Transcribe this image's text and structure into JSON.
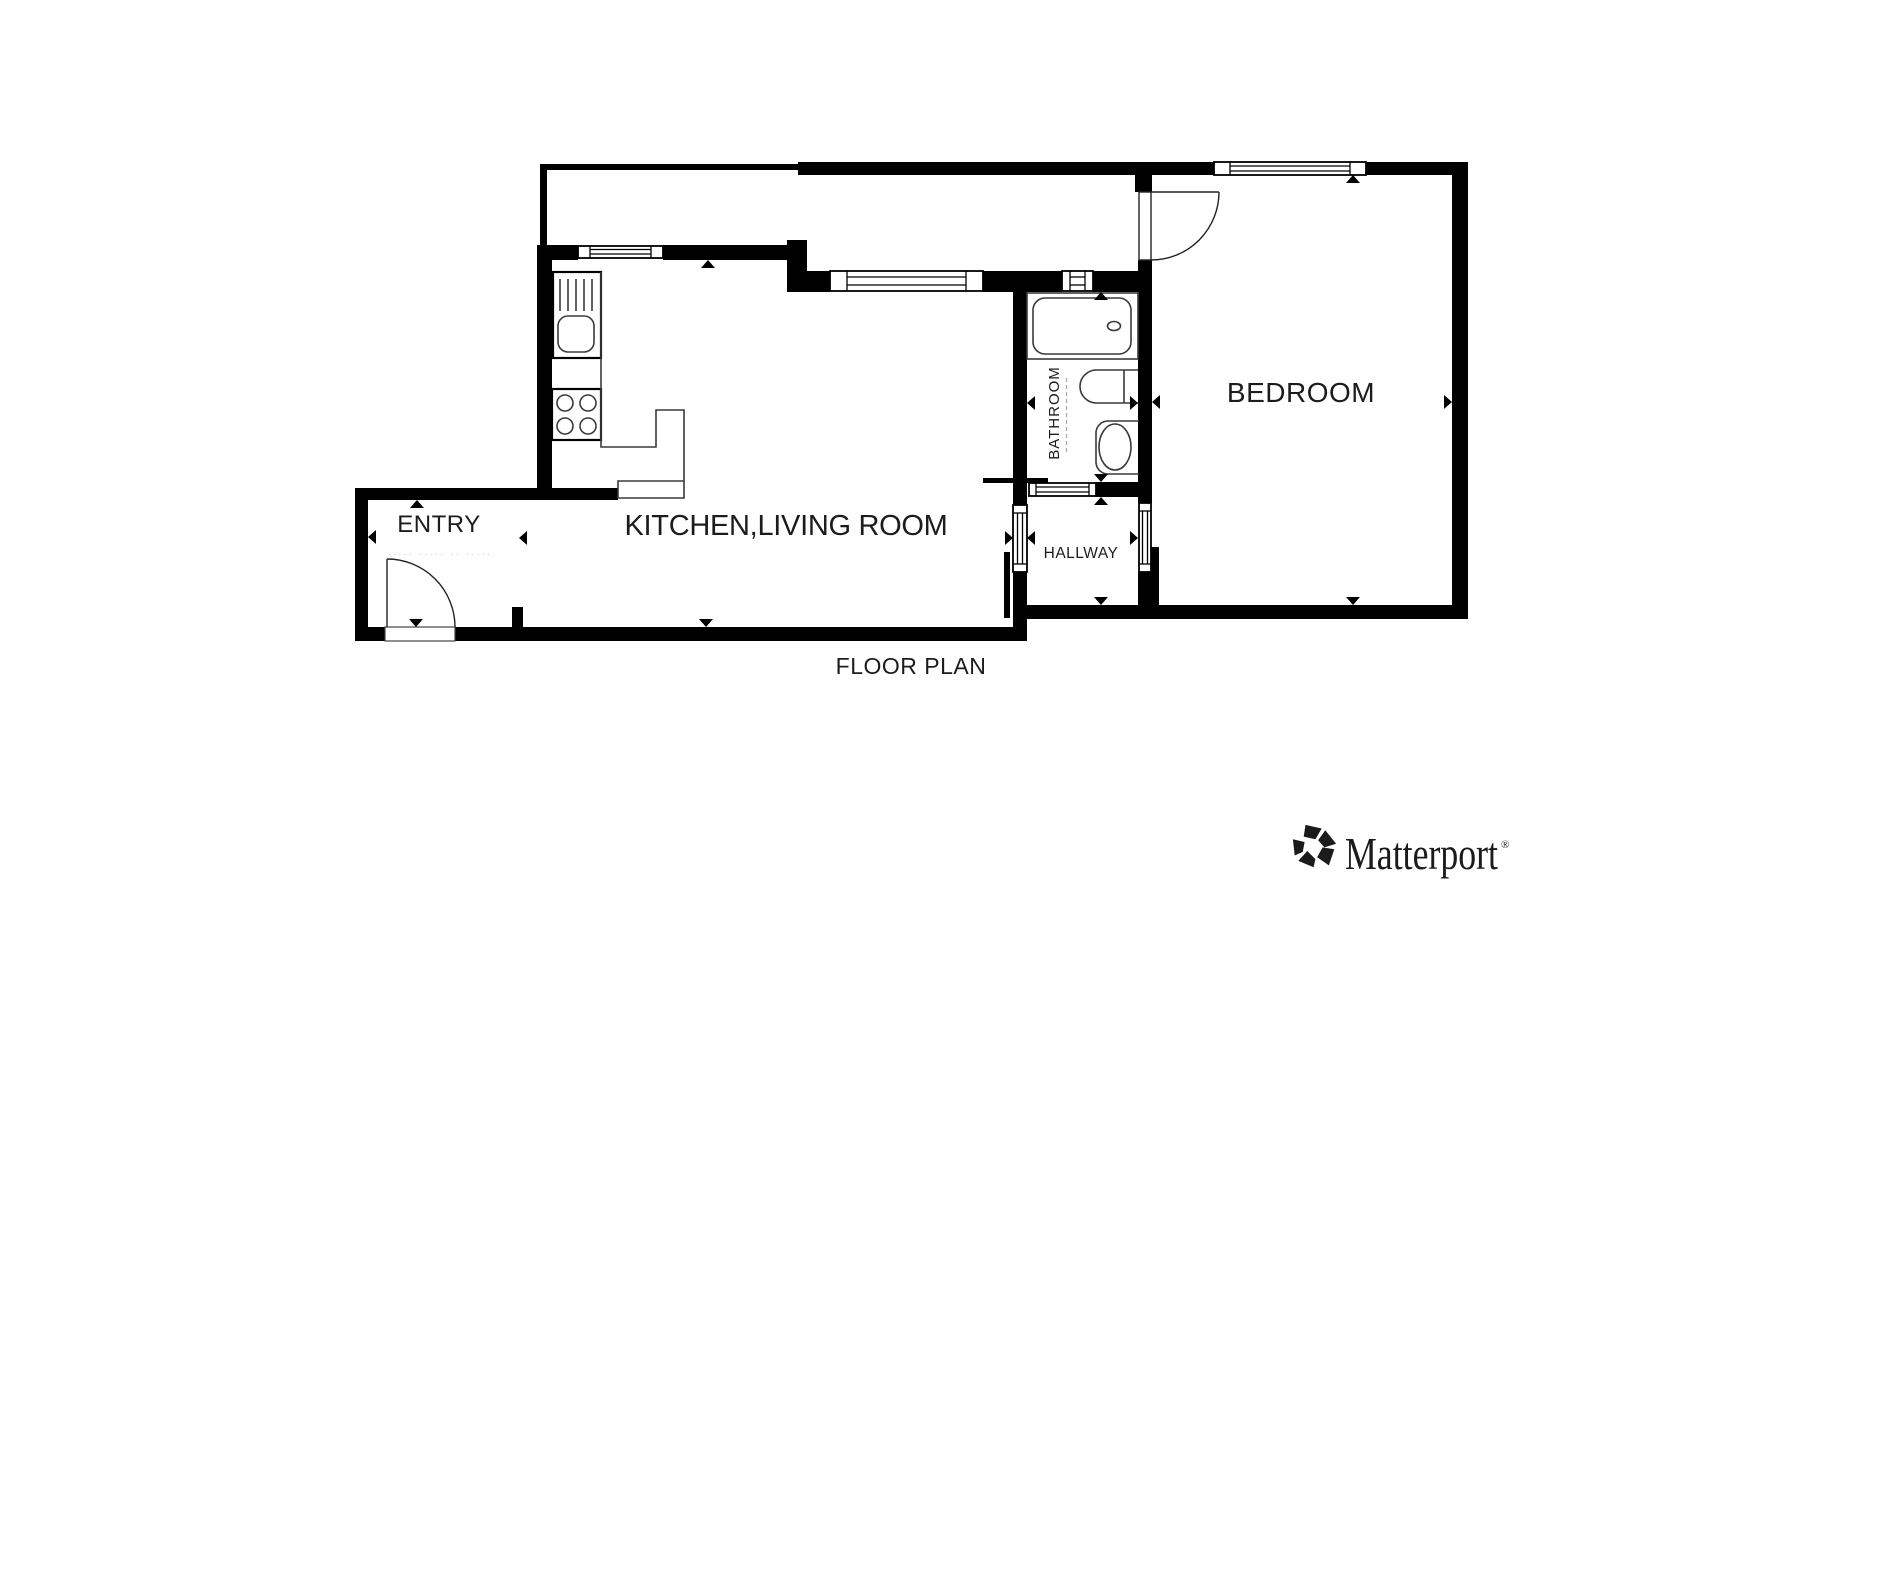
{
  "page": {
    "background": "#ffffff"
  },
  "floor_plan": {
    "caption": "FLOOR PLAN",
    "rooms": {
      "entry": {
        "label": "ENTRY"
      },
      "kitchen_living": {
        "label": "KITCHEN,LIVING ROOM"
      },
      "bathroom": {
        "label": "BATHROOM"
      },
      "hallway": {
        "label": "HALLWAY"
      },
      "bedroom": {
        "label": "BEDROOM"
      }
    },
    "faint_note": "····· ····· ·· ·····",
    "colors": {
      "walls": "#000000",
      "fixture_lines": "#3a3a3a",
      "label_text": "#1c1c1c",
      "faint_text": "#c9c9c9"
    }
  },
  "branding": {
    "name": "Matterport",
    "registered": "®",
    "logo_color": "#1b1b1b"
  }
}
